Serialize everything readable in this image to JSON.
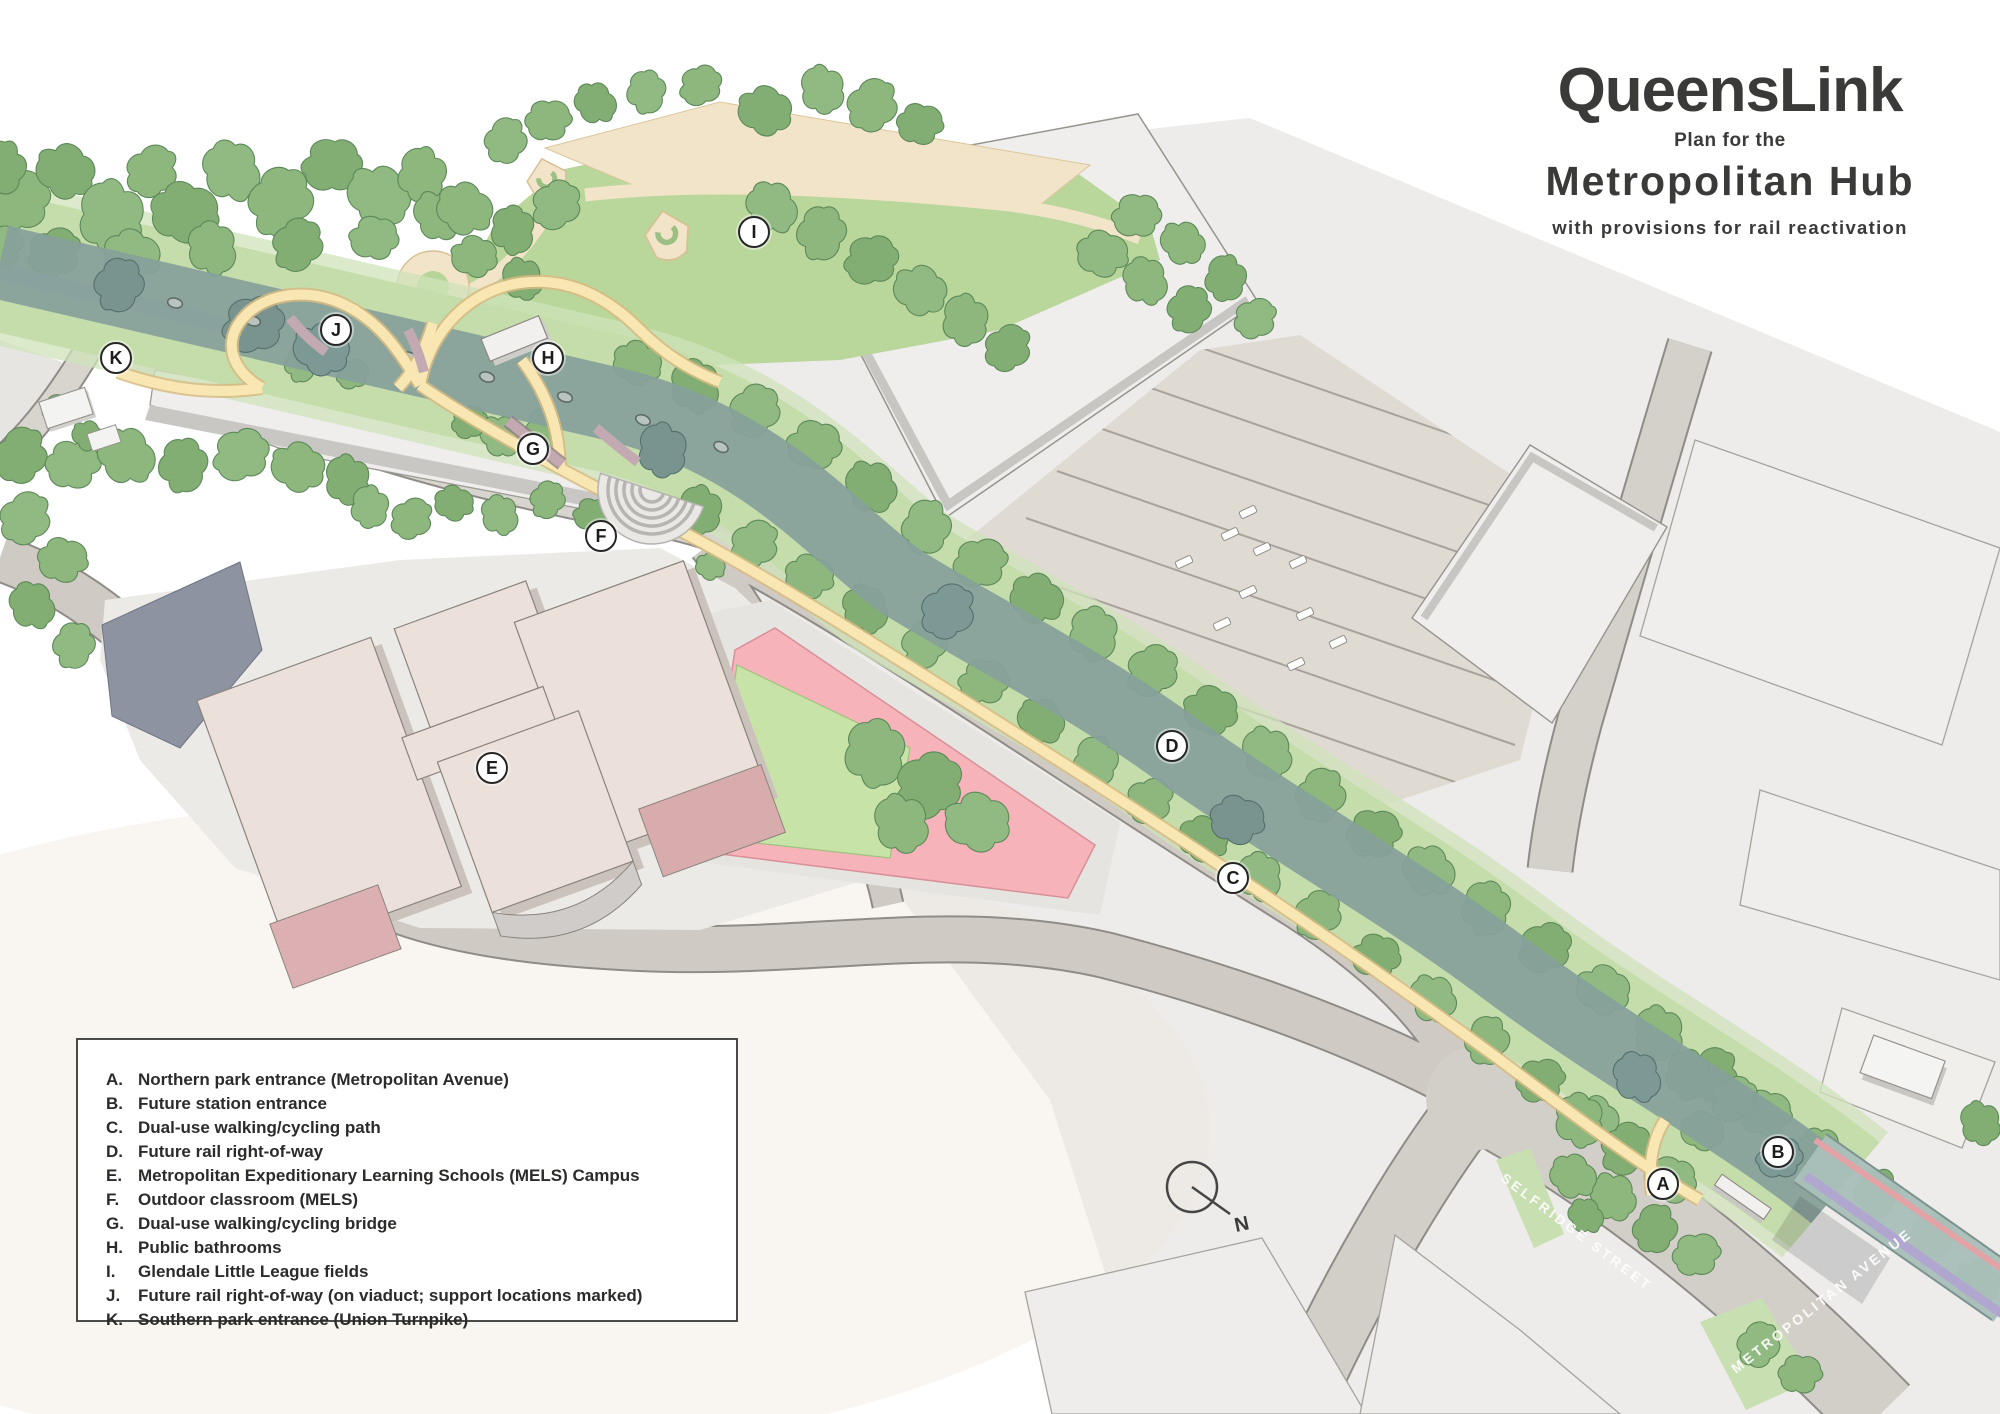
{
  "title": {
    "brand": "QueensLink",
    "subtitle": "Plan for the",
    "name": "Metropolitan Hub",
    "tagline": "with provisions for rail reactivation"
  },
  "legend": {
    "items": [
      {
        "key": "A.",
        "label": "Northern park entrance (Metropolitan Avenue)"
      },
      {
        "key": "B.",
        "label": "Future station entrance"
      },
      {
        "key": "C.",
        "label": "Dual-use walking/cycling path"
      },
      {
        "key": "D.",
        "label": "Future rail right-of-way"
      },
      {
        "key": "E.",
        "label": "Metropolitan Expeditionary Learning Schools (MELS) Campus"
      },
      {
        "key": "F.",
        "label": "Outdoor classroom (MELS)"
      },
      {
        "key": "G.",
        "label": "Dual-use walking/cycling bridge"
      },
      {
        "key": "H.",
        "label": "Public bathrooms"
      },
      {
        "key": "I.",
        "label": "Glendale Little League fields"
      },
      {
        "key": "J.",
        "label": "Future rail right-of-way (on viaduct; support locations marked)"
      },
      {
        "key": "K.",
        "label": "Southern park entrance (Union Turnpike)"
      }
    ]
  },
  "markers": [
    {
      "letter": "A"
    },
    {
      "letter": "B"
    },
    {
      "letter": "C"
    },
    {
      "letter": "D"
    },
    {
      "letter": "E"
    },
    {
      "letter": "F"
    },
    {
      "letter": "G"
    },
    {
      "letter": "H"
    },
    {
      "letter": "I"
    },
    {
      "letter": "J"
    },
    {
      "letter": "K"
    }
  ],
  "map": {
    "street_labels": [
      {
        "text": "SELFRIDGE STREET"
      },
      {
        "text": "METROPOLITAN AVENUE"
      }
    ],
    "compass_label": "N"
  },
  "colors": {
    "rail_row": "#86a09b",
    "path_yellow": "#f9e7b3",
    "tree_green": "#8db77d",
    "grass": "#c5dcab",
    "field_pink": "#f9b3ba",
    "field_green": "#c8e3a8",
    "school_cream": "#ece0da",
    "school_pink": "#dcb0b2",
    "road_gray": "#cfcbc4",
    "viaduct_purple": "#b6add2",
    "bridge_pink": "#e2a2a6",
    "ink": "#3a3a39"
  }
}
